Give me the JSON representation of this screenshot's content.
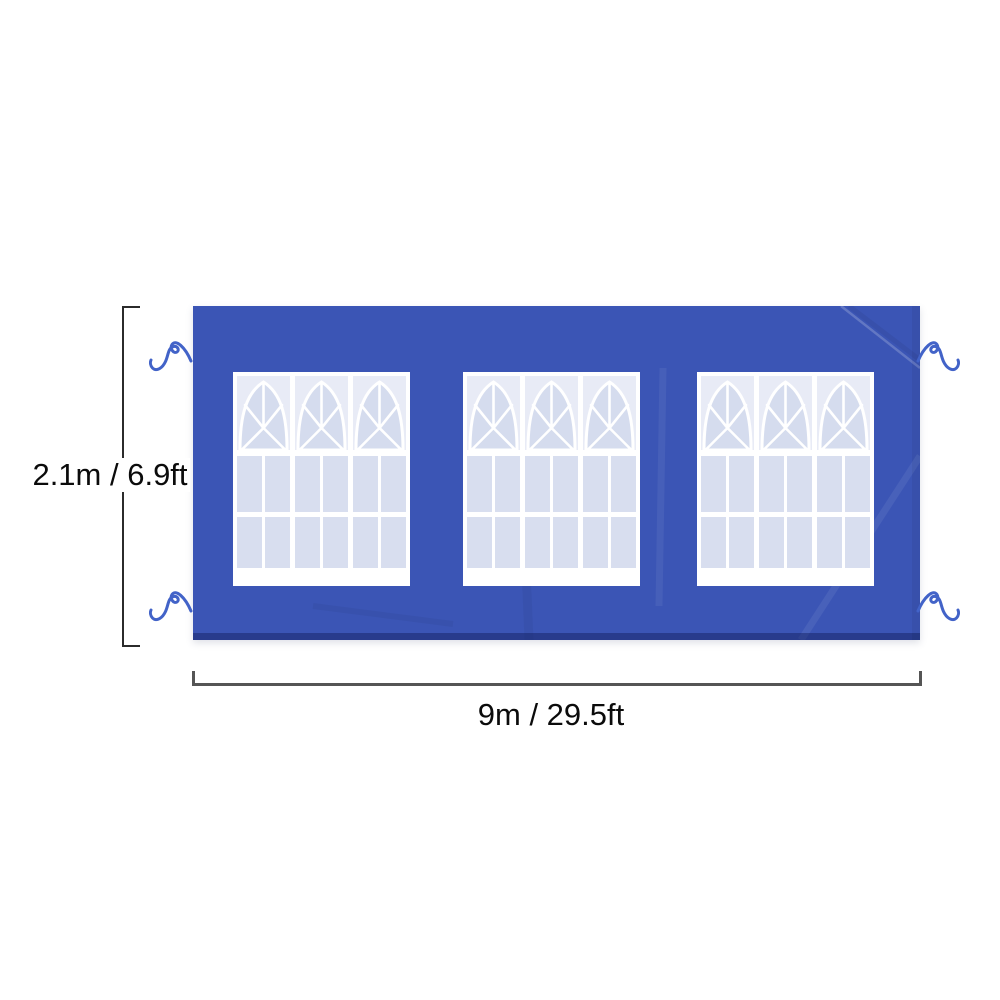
{
  "diagram": {
    "type": "product-dimension-diagram",
    "subject": "canopy tent sidewall with windows",
    "labels": {
      "height": "2.1m / 6.9ft",
      "width": "9m / 29.5ft"
    },
    "tent": {
      "color": "#3b55b5",
      "bottom_edge_color": "#2e45a0",
      "window_count": 3,
      "window": {
        "sections": 3,
        "frame_color": "#ffffff",
        "pane_color": "#d8deef",
        "dome_color": "#d5dcee",
        "corner_color": "#e8ebf6"
      },
      "tie_count": 4,
      "tie_color": "#4263c8"
    },
    "dimension_lines": {
      "height_line_color": "#2b2b2b",
      "width_line_color": "#555555",
      "text_color": "#0b0b0b"
    }
  }
}
